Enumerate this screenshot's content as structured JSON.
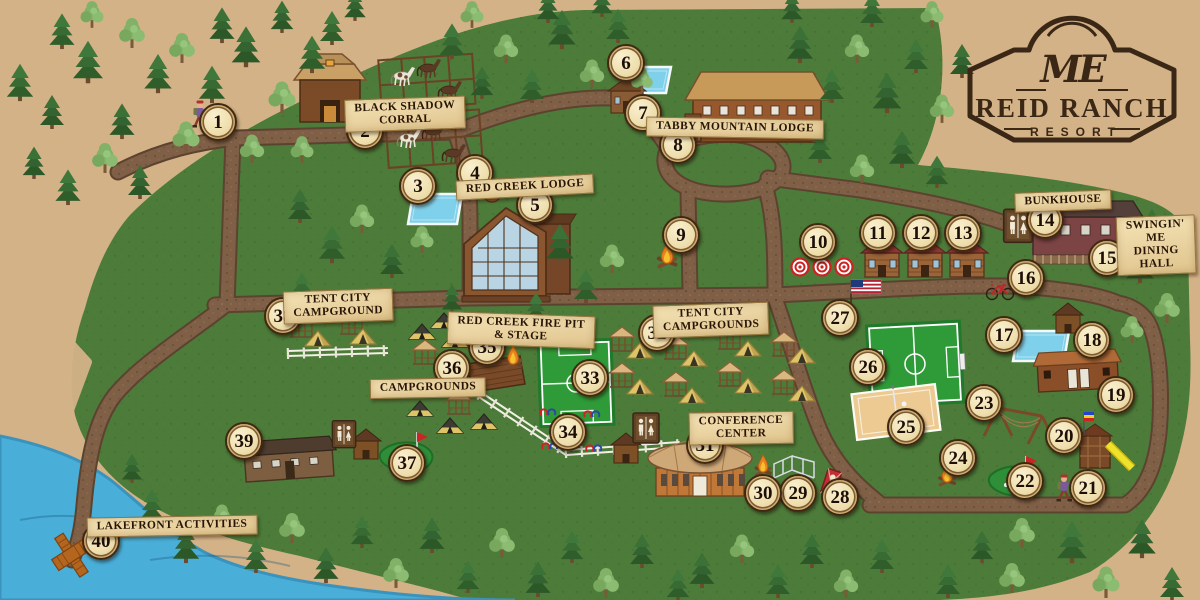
{
  "logo": {
    "monogram": "ME",
    "title": "REID RANCH",
    "subtitle": "RESORT"
  },
  "colors": {
    "parchment": "#d3b287",
    "map_green": "#4d7c3a",
    "map_green_dark": "#3f6b2f",
    "path_brown": "#7f5f46",
    "path_edge": "#5c4330",
    "water": "#49afd9",
    "pool": "#7fd0ea",
    "field_green": "#2f9a38",
    "sand": "#ecca92",
    "marker_face": "#efdfae",
    "marker_ring": "#3f2811",
    "banner": "#e9d2a0",
    "ink": "#2a1708",
    "logo_brown": "#3a2715"
  },
  "labels": [
    {
      "text": "BLACK SHADOW\nCORRAL",
      "x": 405,
      "y": 114,
      "rot": -2
    },
    {
      "text": "RED CREEK LODGE",
      "x": 525,
      "y": 187,
      "rot": -3
    },
    {
      "text": "TABBY MOUNTAIN LODGE",
      "x": 735,
      "y": 128,
      "rot": 1
    },
    {
      "text": "BUNKHOUSE",
      "x": 1063,
      "y": 201,
      "rot": -2
    },
    {
      "text": "SWINGIN' ME\nDINING HALL",
      "x": 1156,
      "y": 245,
      "rot": -2
    },
    {
      "text": "TENT CITY\nCAMPGROUND",
      "x": 338,
      "y": 306,
      "rot": -2
    },
    {
      "text": "RED CREEK FIRE PIT\n& STAGE",
      "x": 521,
      "y": 330,
      "rot": 2
    },
    {
      "text": "CAMPGROUNDS",
      "x": 428,
      "y": 388,
      "rot": -1
    },
    {
      "text": "TENT CITY\nCAMPGROUNDS",
      "x": 711,
      "y": 320,
      "rot": -2
    },
    {
      "text": "CONFERENCE\nCENTER",
      "x": 741,
      "y": 428,
      "rot": -1
    },
    {
      "text": "LAKEFRONT ACTIVITIES",
      "x": 172,
      "y": 526,
      "rot": -1
    }
  ],
  "markers": [
    [
      1,
      218,
      122
    ],
    [
      2,
      365,
      131
    ],
    [
      3,
      418,
      186
    ],
    [
      4,
      475,
      173
    ],
    [
      5,
      535,
      205
    ],
    [
      6,
      626,
      63
    ],
    [
      7,
      643,
      113
    ],
    [
      8,
      678,
      145
    ],
    [
      9,
      681,
      235
    ],
    [
      10,
      818,
      242
    ],
    [
      11,
      878,
      233
    ],
    [
      12,
      921,
      233
    ],
    [
      13,
      963,
      233
    ],
    [
      14,
      1045,
      220
    ],
    [
      15,
      1107,
      258
    ],
    [
      16,
      1026,
      278
    ],
    [
      17,
      1004,
      335
    ],
    [
      18,
      1092,
      340
    ],
    [
      19,
      1116,
      395
    ],
    [
      20,
      1064,
      436
    ],
    [
      21,
      1088,
      488
    ],
    [
      22,
      1025,
      481
    ],
    [
      23,
      984,
      403
    ],
    [
      24,
      958,
      458
    ],
    [
      25,
      906,
      427
    ],
    [
      26,
      868,
      367
    ],
    [
      27,
      840,
      318
    ],
    [
      28,
      840,
      497
    ],
    [
      29,
      798,
      493
    ],
    [
      30,
      763,
      493
    ],
    [
      31,
      705,
      445
    ],
    [
      32,
      657,
      333
    ],
    [
      33,
      590,
      378
    ],
    [
      34,
      568,
      432
    ],
    [
      35,
      487,
      347
    ],
    [
      36,
      452,
      368
    ],
    [
      37,
      407,
      463
    ],
    [
      38,
      283,
      316
    ],
    [
      39,
      244,
      441
    ],
    [
      40,
      101,
      541
    ]
  ],
  "tents_yellow": [
    [
      318,
      346
    ],
    [
      363,
      344
    ],
    [
      640,
      358
    ],
    [
      694,
      366
    ],
    [
      748,
      356
    ],
    [
      802,
      363
    ],
    [
      640,
      394
    ],
    [
      692,
      403
    ],
    [
      748,
      393
    ],
    [
      802,
      401
    ]
  ],
  "tents_dark": [
    [
      422,
      339
    ],
    [
      444,
      328
    ],
    [
      455,
      347
    ],
    [
      420,
      416
    ],
    [
      450,
      433
    ],
    [
      484,
      429
    ]
  ],
  "gazebos": [
    [
      302,
      334
    ],
    [
      352,
      331
    ],
    [
      425,
      361
    ],
    [
      459,
      411
    ],
    [
      622,
      348
    ],
    [
      676,
      356
    ],
    [
      730,
      346
    ],
    [
      784,
      353
    ],
    [
      622,
      384
    ],
    [
      676,
      393
    ],
    [
      730,
      383
    ],
    [
      784,
      391
    ]
  ],
  "features": [
    {
      "type": "soccer-v",
      "x": 576,
      "y": 383
    },
    {
      "type": "soccer-h",
      "x": 915,
      "y": 364
    },
    {
      "type": "sand-court",
      "x": 896,
      "y": 412
    },
    {
      "type": "pool",
      "x": 435,
      "y": 209,
      "w": 54,
      "h": 30
    },
    {
      "type": "pool",
      "x": 645,
      "y": 80,
      "w": 52,
      "h": 26
    },
    {
      "type": "pool",
      "x": 1041,
      "y": 346,
      "w": 56,
      "h": 30
    },
    {
      "type": "hot-tub",
      "x": 492,
      "y": 193
    },
    {
      "type": "minigolf",
      "x": 407,
      "y": 458
    },
    {
      "type": "minigolf",
      "x": 1016,
      "y": 482
    },
    {
      "type": "stage",
      "x": 494,
      "y": 377
    },
    {
      "type": "fence-white",
      "x": 288,
      "y": 356,
      "x2": 388,
      "y2": 353
    },
    {
      "type": "fence-white",
      "x": 479,
      "y": 397,
      "x2": 566,
      "y2": 455
    },
    {
      "type": "fence-white",
      "x": 566,
      "y": 455,
      "x2": 680,
      "y2": 447
    },
    {
      "type": "horseshoes",
      "x": 569,
      "y": 430
    },
    {
      "type": "corral",
      "x": 428,
      "y": 112
    },
    {
      "type": "horse",
      "x": 402,
      "y": 80,
      "v": "paint"
    },
    {
      "type": "horse",
      "x": 428,
      "y": 72,
      "v": "dark"
    },
    {
      "type": "horse",
      "x": 449,
      "y": 94,
      "v": "dark"
    },
    {
      "type": "horse",
      "x": 408,
      "y": 142,
      "v": "paint"
    },
    {
      "type": "horse",
      "x": 433,
      "y": 135,
      "v": "dark"
    },
    {
      "type": "horse",
      "x": 453,
      "y": 157,
      "v": "dark"
    },
    {
      "type": "barn",
      "x": 330,
      "y": 100
    },
    {
      "type": "red-creek-lodge",
      "x": 512,
      "y": 252
    },
    {
      "type": "tabby-lodge",
      "x": 755,
      "y": 112
    },
    {
      "type": "small-cabin",
      "x": 627,
      "y": 101
    },
    {
      "type": "cabin",
      "x": 882,
      "y": 264
    },
    {
      "type": "cabin",
      "x": 925,
      "y": 264
    },
    {
      "type": "cabin",
      "x": 967,
      "y": 264
    },
    {
      "type": "bunkhouse",
      "x": 1085,
      "y": 237
    },
    {
      "type": "long-cabin",
      "x": 1078,
      "y": 377
    },
    {
      "type": "shed",
      "x": 1068,
      "y": 323
    },
    {
      "type": "long-building",
      "x": 289,
      "y": 463
    },
    {
      "type": "conference",
      "x": 700,
      "y": 472
    },
    {
      "type": "shed",
      "x": 626,
      "y": 453
    },
    {
      "type": "shed",
      "x": 366,
      "y": 449
    },
    {
      "type": "restroom",
      "x": 1018,
      "y": 228,
      "s": 1.1
    },
    {
      "type": "restroom",
      "x": 646,
      "y": 430,
      "s": 1.0
    },
    {
      "type": "restroom",
      "x": 344,
      "y": 436,
      "s": 0.9
    },
    {
      "type": "playground",
      "x": 1098,
      "y": 452
    },
    {
      "type": "swing-frame",
      "x": 1012,
      "y": 420
    },
    {
      "type": "wireframe",
      "x": 796,
      "y": 468
    },
    {
      "type": "cornhole",
      "x": 831,
      "y": 483
    },
    {
      "type": "campfire",
      "x": 667,
      "y": 262,
      "s": 1.2
    },
    {
      "type": "campfire",
      "x": 513,
      "y": 363,
      "s": 1.1
    },
    {
      "type": "campfire",
      "x": 947,
      "y": 481,
      "s": 1.05
    },
    {
      "type": "campfire",
      "x": 763,
      "y": 471,
      "s": 1.0
    },
    {
      "type": "targets",
      "x": 822,
      "y": 267
    },
    {
      "type": "flag-usa",
      "x": 851,
      "y": 295
    },
    {
      "type": "bicycle",
      "x": 1000,
      "y": 294
    },
    {
      "type": "dock",
      "x": 72,
      "y": 556
    },
    {
      "type": "hiker",
      "x": 200,
      "y": 120
    },
    {
      "type": "hiker",
      "x": 1064,
      "y": 494
    }
  ],
  "trees": {
    "conifer": [
      [
        20,
        100,
        1.1
      ],
      [
        52,
        128,
        1.0
      ],
      [
        88,
        82,
        1.25
      ],
      [
        122,
        138,
        1.05
      ],
      [
        158,
        92,
        1.15
      ],
      [
        34,
        178,
        0.95
      ],
      [
        68,
        204,
        1.05
      ],
      [
        140,
        198,
        1.0
      ],
      [
        212,
        102,
        1.1
      ],
      [
        246,
        66,
        1.2
      ],
      [
        312,
        72,
        1.1
      ],
      [
        222,
        42,
        1.05
      ],
      [
        62,
        48,
        1.05
      ],
      [
        282,
        32,
        0.95
      ],
      [
        332,
        44,
        1.0
      ],
      [
        355,
        20,
        0.9
      ],
      [
        452,
        58,
        1.05
      ],
      [
        482,
        98,
        0.95
      ],
      [
        532,
        102,
        1.0
      ],
      [
        562,
        48,
        1.15
      ],
      [
        618,
        42,
        1.0
      ],
      [
        548,
        22,
        0.95
      ],
      [
        602,
        16,
        0.9
      ],
      [
        300,
        222,
        1.0
      ],
      [
        332,
        262,
        1.1
      ],
      [
        392,
        277,
        1.0
      ],
      [
        302,
        302,
        0.9
      ],
      [
        560,
        262,
        1.15
      ],
      [
        586,
        302,
        1.0
      ],
      [
        452,
        312,
        0.85
      ],
      [
        536,
        322,
        0.9
      ],
      [
        800,
        62,
        1.1
      ],
      [
        832,
        102,
        1.0
      ],
      [
        887,
        112,
        1.2
      ],
      [
        916,
        72,
        1.0
      ],
      [
        962,
        77,
        1.0
      ],
      [
        820,
        162,
        1.0
      ],
      [
        902,
        167,
        1.1
      ],
      [
        937,
        187,
        0.95
      ],
      [
        792,
        22,
        0.9
      ],
      [
        872,
        26,
        1.0
      ],
      [
        1140,
        282,
        1.15
      ],
      [
        1186,
        272,
        0.9
      ],
      [
        1152,
        242,
        1.0
      ],
      [
        152,
        522,
        1.0
      ],
      [
        186,
        562,
        1.1
      ],
      [
        256,
        572,
        1.0
      ],
      [
        326,
        582,
        1.05
      ],
      [
        362,
        547,
        0.95
      ],
      [
        432,
        552,
        1.05
      ],
      [
        468,
        592,
        0.95
      ],
      [
        538,
        596,
        1.05
      ],
      [
        572,
        562,
        0.95
      ],
      [
        642,
        567,
        1.0
      ],
      [
        678,
        600,
        0.95
      ],
      [
        702,
        587,
        1.05
      ],
      [
        778,
        597,
        1.0
      ],
      [
        812,
        567,
        1.0
      ],
      [
        882,
        572,
        1.0
      ],
      [
        132,
        482,
        0.85
      ],
      [
        948,
        597,
        1.0
      ],
      [
        982,
        562,
        0.95
      ],
      [
        1072,
        562,
        1.25
      ],
      [
        1142,
        557,
        1.15
      ],
      [
        1172,
        600,
        1.0
      ]
    ],
    "deciduous": [
      [
        105,
        172,
        0.95
      ],
      [
        186,
        152,
        1.0
      ],
      [
        282,
        112,
        1.0
      ],
      [
        252,
        162,
        0.9
      ],
      [
        302,
        162,
        0.85
      ],
      [
        182,
        62,
        0.95
      ],
      [
        132,
        47,
        0.95
      ],
      [
        92,
        27,
        0.85
      ],
      [
        506,
        62,
        0.9
      ],
      [
        592,
        87,
        0.9
      ],
      [
        642,
        92,
        0.8
      ],
      [
        472,
        27,
        0.85
      ],
      [
        362,
        232,
        0.9
      ],
      [
        422,
        252,
        0.85
      ],
      [
        612,
        272,
        0.9
      ],
      [
        857,
        62,
        0.9
      ],
      [
        942,
        122,
        0.9
      ],
      [
        862,
        182,
        0.9
      ],
      [
        932,
        27,
        0.85
      ],
      [
        1167,
        322,
        0.95
      ],
      [
        1132,
        342,
        0.85
      ],
      [
        222,
        532,
        0.9
      ],
      [
        292,
        542,
        0.95
      ],
      [
        396,
        587,
        0.95
      ],
      [
        502,
        557,
        0.95
      ],
      [
        606,
        597,
        0.95
      ],
      [
        742,
        562,
        0.9
      ],
      [
        846,
        597,
        0.9
      ],
      [
        1022,
        547,
        0.95
      ],
      [
        1106,
        597,
        1.0
      ],
      [
        1012,
        592,
        0.95
      ]
    ]
  }
}
